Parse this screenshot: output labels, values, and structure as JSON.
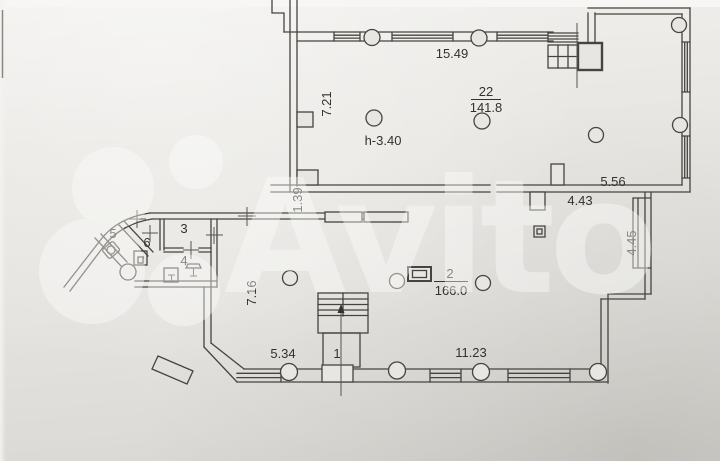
{
  "watermark": {
    "brand_text": "Avito"
  },
  "rooms": {
    "upper": {
      "number": "22",
      "area": "141.8",
      "ceiling_height": "h-3.40"
    },
    "main": {
      "number": "2",
      "area": "166.0"
    },
    "stair": {
      "number": "1"
    },
    "r3": "3",
    "r4": "4",
    "r5": "5",
    "r6": "6"
  },
  "dimensions": {
    "top_wall": "15.49",
    "upper_left": "7.21",
    "upper_right": "5.56",
    "gap": "1.39",
    "mid_right": "4.43",
    "lower_right": "4.45",
    "lower_left": "7.16",
    "bottom_left": "5.34",
    "bottom_right": "11.23"
  },
  "colors": {
    "paper": "#e9e7e3",
    "ink": "#46443f",
    "watermark": "#ffffff"
  }
}
